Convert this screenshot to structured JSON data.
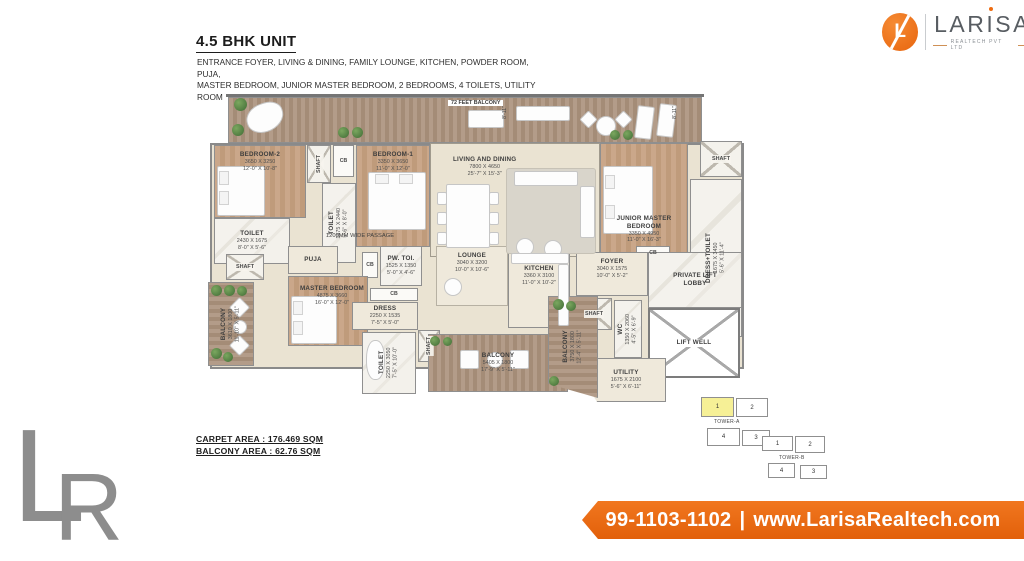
{
  "header": {
    "title": "4.5 BHK UNIT",
    "desc_line1": "ENTRANCE FOYER, LIVING & DINING, FAMILY LOUNGE, KITCHEN, POWDER ROOM, PUJA,",
    "desc_line2": "MASTER BEDROOM, JUNIOR MASTER BEDROOM, 2 BEDROOMS, 4 TOILETS, UTILITY ROOM"
  },
  "logo": {
    "monogram": "L",
    "brand_part1": "LAR",
    "brand_i": "I",
    "brand_part2": "SA",
    "tagline": "REALTECH PVT LTD"
  },
  "colors": {
    "brand_orange": "#ee6c11",
    "keyplan_highlight": "#f6f096"
  },
  "areas": {
    "carpet": "CARPET AREA : 176.469 SQM",
    "balcony": "BALCONY AREA : 62.76 SQM"
  },
  "footer": {
    "phone": "99-1103-1102",
    "separator": "|",
    "website": "www.LarisaRealtech.com"
  },
  "watermark": {
    "letter_l": "L",
    "letter_r": "R"
  },
  "plan": {
    "labels": {
      "shaft": "SHAFT",
      "cb": "CB",
      "passage": "1200MM WIDE PASSAGE",
      "dim": "8'-11\""
    },
    "rooms": {
      "balcony_top": {
        "name": "72 FEET BALCONY"
      },
      "bedroom2": {
        "name": "BEDROOM-2",
        "mm": "3650 X 3250",
        "ft": "12'-0\" X 10'-8\""
      },
      "bedroom1": {
        "name": "BEDROOM-1",
        "mm": "3350 X 3650",
        "ft": "11'-0\" X 12'-0\""
      },
      "toilet_bedroom1": {
        "name": "TOILET",
        "mm": "1675 X 2440",
        "ft": "5'-6\" X 8'-0\""
      },
      "toilet_bedroom2": {
        "name": "TOILET",
        "mm": "2430 X 1675",
        "ft": "8'-0\" X 5'-6\""
      },
      "living_dining": {
        "name": "LIVING AND DINING",
        "mm": "7800 X 4650",
        "ft": "25'-7\" X 15'-3\""
      },
      "junior_master": {
        "name": "JUNIOR MASTER BEDROOM",
        "mm": "3350 X 4950",
        "ft": "11'-0\" X 16'-3\""
      },
      "dress_toilet": {
        "name": "DRESS+TOILET",
        "mm": "1675 X 3450",
        "ft": "5'-6\" X 11'-4\""
      },
      "master": {
        "name": "MASTER BEDROOM",
        "mm": "4875 X 3660",
        "ft": "16'-0\" X 12'-0\""
      },
      "dress": {
        "name": "DRESS",
        "mm": "2250 X 1535",
        "ft": "7'-5\" X 5'-0\""
      },
      "toilet_master": {
        "name": "TOILET",
        "mm": "2250 X 3050",
        "ft": "7'-5\" X 10'-0\""
      },
      "powder": {
        "name": "PW. TOI.",
        "mm": "1525 X 1350",
        "ft": "5'-0\" X 4'-6\""
      },
      "puja": {
        "name": "PUJA"
      },
      "lounge": {
        "name": "LOUNGE",
        "mm": "3040 X 3200",
        "ft": "10'-0\" X 10'-6\""
      },
      "kitchen": {
        "name": "KITCHEN",
        "mm": "3360 X 3100",
        "ft": "11'-0\" X 10'-2\""
      },
      "foyer": {
        "name": "FOYER",
        "mm": "3040 X 1575",
        "ft": "10'-0\" X 5'-2\""
      },
      "wc": {
        "name": "WC",
        "mm": "1350 X 2060",
        "ft": "4'-5\" X 6'-9\""
      },
      "utility": {
        "name": "UTILITY",
        "mm": "1675 X 2100",
        "ft": "5'-6\" X 6'-11\""
      },
      "private_lift_lobby": {
        "name": "PRIVATE LIFT LOBBY"
      },
      "lift_well": {
        "name": "LIFT WELL"
      },
      "balcony_left": {
        "name": "BALCONY",
        "mm": "3610 X 1800",
        "ft": "11'-10\" X 5'-11\""
      },
      "balcony_bottom": {
        "name": "BALCONY",
        "mm": "5405 X 1800",
        "ft": "17'-9\" X 5'-11\""
      },
      "balcony_right": {
        "name": "BALCONY",
        "mm": "3750 X 1800",
        "ft": "12'-4\" X 5'-11\""
      }
    }
  },
  "keyplan": {
    "tower_a": {
      "name": "TOWER-A",
      "units": [
        "1",
        "2",
        "3",
        "4"
      ]
    },
    "tower_b": {
      "name": "TOWER-B",
      "units": [
        "1",
        "2",
        "3",
        "4"
      ]
    }
  }
}
